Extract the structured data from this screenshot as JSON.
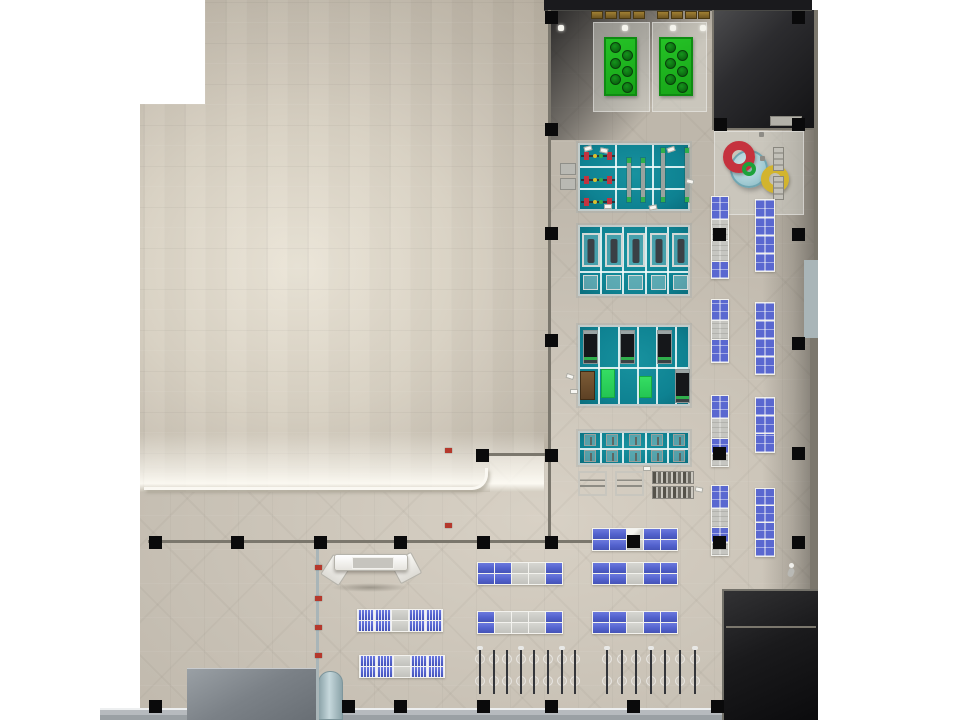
{
  "scene": {
    "width": 960,
    "height": 720,
    "description": "Top-down 3D architectural rendering of a fitness club floor plan with exercise platforms, spa pools, benches and bike parking"
  },
  "palette": {
    "floor": "#c9c2b6",
    "roof": "#cdc6b8",
    "platform_teal": "#0e8292",
    "table_blue": "#5a68d0",
    "mat_green": "#17a518",
    "bright_green": "#35dd63",
    "ring_red": "#c5323e",
    "ring_yellow": "#d2b42e",
    "pool_blue": "#a7ced6",
    "dark_zone": "#1b1b1e",
    "column_black": "#0a0a0b",
    "sidewalk_gray": "#b4b8bc",
    "brown": "#8a6c28"
  },
  "plan": {
    "zones": [
      {
        "name": "gym-floor",
        "cls": "floor",
        "poly": [
          [
            548,
            10
          ],
          [
            818,
            10
          ],
          [
            818,
            720
          ],
          [
            140,
            720
          ],
          [
            140,
            492
          ],
          [
            490,
            492
          ],
          [
            490,
            454
          ],
          [
            548,
            454
          ]
        ]
      },
      {
        "name": "roof-area",
        "cls": "beige",
        "poly": [
          [
            205,
            0
          ],
          [
            548,
            0
          ],
          [
            548,
            454
          ],
          [
            490,
            454
          ],
          [
            490,
            492
          ],
          [
            140,
            492
          ],
          [
            140,
            104
          ],
          [
            205,
            104
          ]
        ]
      },
      {
        "name": "roof-edge-glow",
        "cls": "beige-glow",
        "rect": [
          140,
          432,
          404,
          60
        ]
      },
      {
        "name": "roof-rounded-edge",
        "cls": "round-edge",
        "rect": [
          144,
          468,
          344,
          22
        ]
      },
      {
        "name": "shade-top-left",
        "cls": "shade-tl",
        "rect": [
          548,
          10,
          175,
          130
        ]
      },
      {
        "name": "dark-zone-top-right",
        "cls": "dark-tr",
        "rect": [
          712,
          10,
          106,
          120
        ]
      },
      {
        "name": "right-edge-shade",
        "cls": "right-shade",
        "rect": [
          762,
          130,
          56,
          460
        ]
      },
      {
        "name": "roof-top-band",
        "cls": "top-band",
        "rect": [
          544,
          0,
          268,
          11
        ]
      },
      {
        "name": "sidewalk",
        "cls": "sidewalk",
        "rect": [
          100,
          708,
          622,
          12
        ]
      },
      {
        "name": "dark-zone-bottom-right",
        "cls": "dark-br",
        "rect": [
          722,
          589,
          96,
          131
        ]
      },
      {
        "name": "utility-box",
        "cls": "graybox",
        "rect": [
          187,
          668,
          131,
          52
        ]
      },
      {
        "name": "cylinder-column",
        "cls": "cylinder",
        "rect": [
          318,
          671,
          25,
          49
        ]
      },
      {
        "name": "spa-pad",
        "cls": "pad",
        "rect": [
          714,
          131,
          90,
          84
        ]
      },
      {
        "name": "mat-pad-1",
        "cls": "pad",
        "rect": [
          593,
          22,
          57,
          90
        ]
      },
      {
        "name": "mat-pad-2",
        "cls": "pad",
        "rect": [
          652,
          22,
          55,
          90
        ]
      }
    ],
    "walls": [
      [
        548,
        10,
        3,
        446,
        ""
      ],
      [
        482,
        453,
        70,
        3,
        ""
      ],
      [
        548,
        453,
        3,
        90,
        ""
      ],
      [
        148,
        540,
        494,
        3,
        ""
      ],
      [
        316,
        543,
        3,
        177,
        "light"
      ],
      [
        712,
        10,
        2,
        120,
        ""
      ],
      [
        712,
        128,
        106,
        2,
        ""
      ],
      [
        814,
        10,
        4,
        250,
        ""
      ],
      [
        804,
        260,
        14,
        78,
        "light"
      ],
      [
        810,
        338,
        8,
        251,
        ""
      ],
      [
        726,
        626,
        90,
        2,
        ""
      ]
    ],
    "columns": [
      [
        551,
        17
      ],
      [
        798,
        17
      ],
      [
        551,
        129
      ],
      [
        720,
        124
      ],
      [
        798,
        124
      ],
      [
        551,
        233
      ],
      [
        719,
        234
      ],
      [
        798,
        234
      ],
      [
        551,
        340
      ],
      [
        798,
        343
      ],
      [
        482,
        455
      ],
      [
        551,
        455
      ],
      [
        719,
        453
      ],
      [
        798,
        453
      ],
      [
        155,
        542
      ],
      [
        237,
        542
      ],
      [
        320,
        542
      ],
      [
        400,
        542
      ],
      [
        483,
        542
      ],
      [
        551,
        542
      ],
      [
        633,
        541
      ],
      [
        719,
        542
      ],
      [
        798,
        542
      ],
      [
        155,
        706
      ],
      [
        348,
        706
      ],
      [
        400,
        706
      ],
      [
        483,
        706
      ],
      [
        551,
        706
      ],
      [
        633,
        706
      ],
      [
        717,
        706
      ]
    ],
    "platforms": [
      {
        "rect": [
          578,
          143,
          112,
          68
        ],
        "v": [
          615,
          652
        ],
        "h": [
          166,
          188
        ]
      },
      {
        "rect": [
          578,
          225,
          112,
          71
        ],
        "v": [
          600,
          622,
          645,
          667
        ],
        "h": [
          271
        ]
      },
      {
        "rect": [
          578,
          325,
          112,
          81
        ],
        "v": [
          598,
          618,
          637,
          656,
          675
        ],
        "h": [
          367
        ]
      },
      {
        "rect": [
          578,
          431,
          112,
          34
        ],
        "v": [
          600,
          622,
          645,
          667
        ],
        "h": [
          448
        ]
      }
    ],
    "equipment": [
      {
        "t": "bar",
        "x": 581,
        "y": 151
      },
      {
        "t": "bar",
        "x": 581,
        "y": 175
      },
      {
        "t": "bar",
        "x": 581,
        "y": 197
      },
      {
        "t": "vrack",
        "x": 627,
        "y": 158,
        "h": 44
      },
      {
        "t": "vrack",
        "x": 641,
        "y": 158,
        "h": 44
      },
      {
        "t": "vrack",
        "x": 661,
        "y": 148,
        "h": 54
      },
      {
        "t": "vrack",
        "x": 685,
        "y": 148,
        "h": 54
      },
      {
        "t": "bench",
        "x": 582,
        "y": 233
      },
      {
        "t": "bench",
        "x": 605,
        "y": 233
      },
      {
        "t": "bench",
        "x": 627,
        "y": 233
      },
      {
        "t": "bench",
        "x": 650,
        "y": 233
      },
      {
        "t": "bench",
        "x": 672,
        "y": 233
      },
      {
        "t": "sbench",
        "x": 583,
        "y": 275
      },
      {
        "t": "sbench",
        "x": 606,
        "y": 275
      },
      {
        "t": "sbench",
        "x": 628,
        "y": 275
      },
      {
        "t": "sbench",
        "x": 651,
        "y": 275
      },
      {
        "t": "sbench",
        "x": 673,
        "y": 275
      },
      {
        "t": "tread",
        "x": 583,
        "y": 330
      },
      {
        "t": "tread",
        "x": 620,
        "y": 330
      },
      {
        "t": "tread",
        "x": 657,
        "y": 330
      },
      {
        "t": "tread",
        "x": 675,
        "y": 369
      },
      {
        "t": "brown",
        "x": 580,
        "y": 371
      },
      {
        "t": "bmat",
        "x": 601,
        "y": 369,
        "w": 14,
        "h": 29
      },
      {
        "t": "bmat",
        "x": 639,
        "y": 376,
        "w": 13,
        "h": 22
      },
      {
        "t": "mini",
        "x": 584,
        "y": 434
      },
      {
        "t": "mini",
        "x": 606,
        "y": 434
      },
      {
        "t": "mini",
        "x": 629,
        "y": 434
      },
      {
        "t": "mini",
        "x": 651,
        "y": 434
      },
      {
        "t": "mini",
        "x": 673,
        "y": 434
      },
      {
        "t": "mini",
        "x": 584,
        "y": 450
      },
      {
        "t": "mini",
        "x": 606,
        "y": 450
      },
      {
        "t": "mini",
        "x": 629,
        "y": 450
      },
      {
        "t": "mini",
        "x": 651,
        "y": 450
      },
      {
        "t": "mini",
        "x": 673,
        "y": 450
      },
      {
        "t": "fwbench",
        "x": 578,
        "y": 471
      },
      {
        "t": "fwbench",
        "x": 615,
        "y": 471
      },
      {
        "t": "dbrack",
        "x": 652,
        "y": 471
      },
      {
        "t": "dbrack",
        "x": 652,
        "y": 486
      },
      {
        "t": "gblock",
        "x": 560,
        "y": 163
      },
      {
        "t": "gblock",
        "x": 560,
        "y": 178
      }
    ],
    "papers": [
      [
        584,
        146,
        -15
      ],
      [
        600,
        148,
        12
      ],
      [
        667,
        147,
        -18
      ],
      [
        686,
        179,
        14
      ],
      [
        604,
        204,
        0
      ],
      [
        649,
        205,
        -12
      ],
      [
        566,
        374,
        18
      ],
      [
        570,
        389,
        0
      ],
      [
        643,
        466,
        0
      ],
      [
        695,
        487,
        12
      ]
    ],
    "mats": [
      {
        "x": 604,
        "y": 37,
        "w": 33,
        "h": 59,
        "circles": [
          [
            9,
            8
          ],
          [
            21,
            16
          ],
          [
            9,
            24
          ],
          [
            21,
            32
          ],
          [
            9,
            40
          ],
          [
            21,
            48
          ]
        ]
      },
      {
        "x": 659,
        "y": 37,
        "w": 34,
        "h": 59,
        "circles": [
          [
            9,
            8
          ],
          [
            21,
            16
          ],
          [
            9,
            24
          ],
          [
            21,
            32
          ],
          [
            9,
            40
          ],
          [
            21,
            48
          ]
        ]
      }
    ],
    "brown_benches": [
      [
        591,
        11
      ],
      [
        605,
        11
      ],
      [
        619,
        11
      ],
      [
        633,
        11
      ],
      [
        657,
        11
      ],
      [
        671,
        11
      ],
      [
        685,
        11
      ],
      [
        698,
        11
      ]
    ],
    "light_dots": [
      [
        558,
        25
      ],
      [
        622,
        25
      ],
      [
        670,
        25
      ],
      [
        700,
        25
      ]
    ],
    "spa": {
      "pool": {
        "x": 730,
        "y": 150,
        "d": 38
      },
      "red_ring": {
        "x": 723,
        "y": 141,
        "d": 32,
        "bw": 9
      },
      "green_ring": {
        "x": 742,
        "y": 162,
        "d": 14,
        "bw": 4
      },
      "yellow_ring": {
        "x": 761,
        "y": 165,
        "d": 28,
        "bw": 8
      },
      "lockers": [
        [
          770,
          116,
          32,
          10
        ],
        [
          773,
          147,
          11,
          24
        ],
        [
          773,
          176,
          11,
          24
        ]
      ],
      "dots": [
        [
          759,
          132
        ],
        [
          760,
          156
        ]
      ]
    },
    "strips": [
      {
        "x": 711,
        "y": 196,
        "w": 18,
        "cells": [
          [
            22,
            "b"
          ],
          [
            20,
            "g"
          ],
          [
            20,
            "g"
          ],
          [
            16,
            "b"
          ]
        ]
      },
      {
        "x": 755,
        "y": 199,
        "w": 20,
        "cells": [
          [
            17,
            "b"
          ],
          [
            17,
            "b"
          ],
          [
            17,
            "b"
          ],
          [
            17,
            "b"
          ]
        ]
      },
      {
        "x": 711,
        "y": 299,
        "w": 18,
        "cells": [
          [
            20,
            "b"
          ],
          [
            18,
            "g"
          ],
          [
            22,
            "b"
          ]
        ]
      },
      {
        "x": 755,
        "y": 302,
        "w": 20,
        "cells": [
          [
            17,
            "b"
          ],
          [
            17,
            "b"
          ],
          [
            17,
            "b"
          ],
          [
            17,
            "b"
          ]
        ]
      },
      {
        "x": 711,
        "y": 395,
        "w": 18,
        "cells": [
          [
            22,
            "b"
          ],
          [
            19,
            "g"
          ],
          [
            14,
            "b"
          ],
          [
            12,
            "g"
          ]
        ]
      },
      {
        "x": 755,
        "y": 397,
        "w": 20,
        "cells": [
          [
            17,
            "b"
          ],
          [
            17,
            "b"
          ],
          [
            18,
            "b"
          ]
        ]
      },
      {
        "x": 711,
        "y": 485,
        "w": 18,
        "cells": [
          [
            22,
            "b"
          ],
          [
            18,
            "g"
          ],
          [
            14,
            "b"
          ],
          [
            12,
            "g"
          ]
        ]
      },
      {
        "x": 755,
        "y": 488,
        "w": 20,
        "cells": [
          [
            16,
            "b"
          ],
          [
            16,
            "b"
          ],
          [
            16,
            "b"
          ],
          [
            16,
            "b"
          ]
        ]
      }
    ],
    "tables": [
      {
        "x": 592,
        "y": 528,
        "rows": [
          "BBWBB",
          "BBGBB"
        ]
      },
      {
        "x": 477,
        "y": 562,
        "rows": [
          "BBGGB",
          "BBGGB"
        ]
      },
      {
        "x": 592,
        "y": 562,
        "rows": [
          "BBGBB",
          "BBGBB"
        ]
      },
      {
        "x": 357,
        "y": 609,
        "rows": [
          "BBGBB",
          "BBGBB"
        ],
        "detail": true
      },
      {
        "x": 477,
        "y": 611,
        "rows": [
          "BGGGB",
          "BGGGB"
        ]
      },
      {
        "x": 592,
        "y": 611,
        "rows": [
          "BBGBB",
          "BBGBB"
        ]
      },
      {
        "x": 359,
        "y": 655,
        "rows": [
          "BBGBB",
          "BBGBB"
        ],
        "detail": true
      }
    ],
    "bike_rows": [
      {
        "x": 474,
        "y": 646,
        "count": 8,
        "spacing": 13.6
      },
      {
        "x": 601,
        "y": 646,
        "count": 7,
        "spacing": 14.6
      }
    ],
    "reception": {
      "shadow": [
        331,
        583,
        78,
        9
      ],
      "wing_left": [
        325,
        558,
        22,
        24
      ],
      "wing_right": [
        394,
        556,
        24,
        24
      ],
      "main": [
        334,
        554,
        74,
        17
      ],
      "counter": [
        352,
        557,
        42,
        12
      ]
    },
    "red_items": [
      [
        315,
        565
      ],
      [
        315,
        596
      ],
      [
        315,
        625
      ],
      [
        315,
        653
      ],
      [
        445,
        448
      ],
      [
        445,
        523
      ]
    ],
    "person": {
      "x": 786,
      "y": 562
    }
  }
}
